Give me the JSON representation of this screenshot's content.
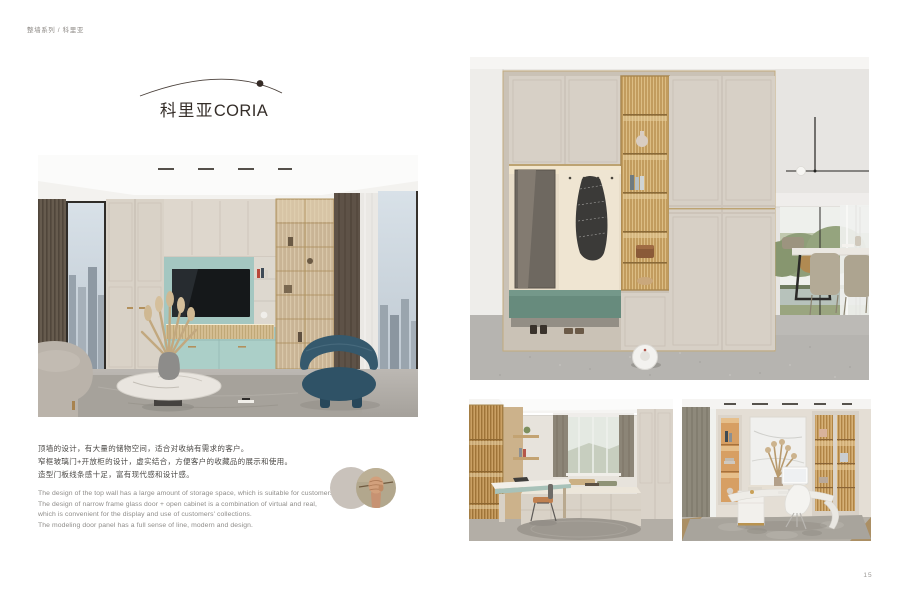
{
  "page": {
    "breadcrumb": "整墙系列 / 科里亚",
    "page_number": "15"
  },
  "title": {
    "cn": "科里亚",
    "en": "CORIA"
  },
  "intro_cn": {
    "lines": [
      "顶墙的设计，有大量的储物空间，适合对收纳有需求的客户。",
      "窄框玻璃门+开放柜的设计，虚实结合，方便客户的收藏品的展示和使用。",
      "造型门板线条感十足，富有现代感和设计感。"
    ]
  },
  "intro_en": {
    "lines": [
      "The design of the top wall has a large amount of storage space, which is suitable for customers who need storage.",
      "The design of narrow frame glass door + open cabinet is a combination of virtual and real,",
      "which is convenient for the display and use of customers' collections.",
      "The modeling door panel has a full sense of line, modern and design."
    ]
  },
  "photos": {
    "living_room": "Living room with cream full-wall cabinets, teal TV niche and lit glass display cabinet",
    "entryway": "Entryway cabinet with fluted glass display column, mirror niche, coat hooks, green bench and robot vacuum",
    "study": "Study with bay window, platform seating and built-in desk",
    "office": "Home office with curved desk, monitor and illuminated display cabinets",
    "detail_hand": "Hand holding a thin wooden rod"
  },
  "colors": {
    "accent_teal": "#a4c7c1",
    "bench_green": "#678b7d",
    "cabinet_cream": "#d7d0c6",
    "glass_amber": "#c09a5c",
    "title_ink": "#352e29"
  }
}
